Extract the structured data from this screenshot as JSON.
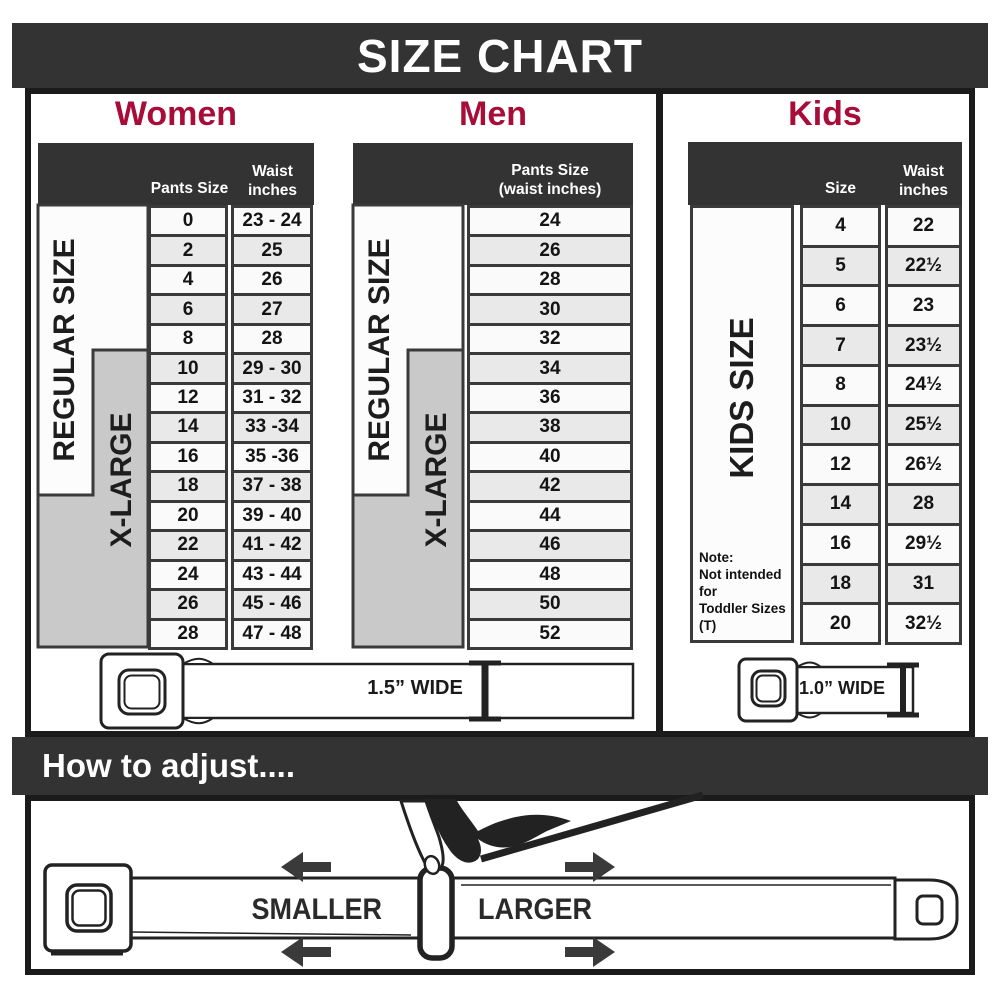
{
  "title": "SIZE CHART",
  "sections": {
    "women": {
      "heading": "Women",
      "header": {
        "pants": "Pants Size",
        "waist_line1": "Waist",
        "waist_line2": "inches"
      },
      "regular_label": "REGULAR SIZE",
      "xlarge_label": "X-LARGE",
      "rows": [
        {
          "pants_size": "0",
          "waist_inches": "23 - 24"
        },
        {
          "pants_size": "2",
          "waist_inches": "25"
        },
        {
          "pants_size": "4",
          "waist_inches": "26"
        },
        {
          "pants_size": "6",
          "waist_inches": "27"
        },
        {
          "pants_size": "8",
          "waist_inches": "28"
        },
        {
          "pants_size": "10",
          "waist_inches": "29 - 30"
        },
        {
          "pants_size": "12",
          "waist_inches": "31 - 32"
        },
        {
          "pants_size": "14",
          "waist_inches": "33 -34"
        },
        {
          "pants_size": "16",
          "waist_inches": "35 -36"
        },
        {
          "pants_size": "18",
          "waist_inches": "37 - 38"
        },
        {
          "pants_size": "20",
          "waist_inches": "39 - 40"
        },
        {
          "pants_size": "22",
          "waist_inches": "41 - 42"
        },
        {
          "pants_size": "24",
          "waist_inches": "43 - 44"
        },
        {
          "pants_size": "26",
          "waist_inches": "45 - 46"
        },
        {
          "pants_size": "28",
          "waist_inches": "47 - 48"
        }
      ]
    },
    "men": {
      "heading": "Men",
      "header": {
        "line1": "Pants Size",
        "line2": "(waist inches)"
      },
      "regular_label": "REGULAR SIZE",
      "xlarge_label": "X-LARGE",
      "rows": [
        "24",
        "26",
        "28",
        "30",
        "32",
        "34",
        "36",
        "38",
        "40",
        "42",
        "44",
        "46",
        "48",
        "50",
        "52"
      ]
    },
    "kids": {
      "heading": "Kids",
      "header": {
        "size": "Size",
        "waist_line1": "Waist",
        "waist_line2": "inches"
      },
      "side_label": "KIDS SIZE",
      "note_lines": [
        "Note:",
        "Not intended for",
        "Toddler Sizes (T)"
      ],
      "rows": [
        {
          "size": "4",
          "waist_inches": "22"
        },
        {
          "size": "5",
          "waist_inches": "22½"
        },
        {
          "size": "6",
          "waist_inches": "23"
        },
        {
          "size": "7",
          "waist_inches": "23½"
        },
        {
          "size": "8",
          "waist_inches": "24½"
        },
        {
          "size": "10",
          "waist_inches": "25½"
        },
        {
          "size": "12",
          "waist_inches": "26½"
        },
        {
          "size": "14",
          "waist_inches": "28"
        },
        {
          "size": "16",
          "waist_inches": "29½"
        },
        {
          "size": "18",
          "waist_inches": "31"
        },
        {
          "size": "20",
          "waist_inches": "32½"
        }
      ]
    }
  },
  "belts": {
    "adult_width_label": "1.5” WIDE",
    "kids_width_label": "1.0” WIDE"
  },
  "how_to_adjust": {
    "heading": "How to adjust....",
    "smaller_label": "SMALLER",
    "larger_label": "LARGER"
  },
  "colors": {
    "heading_red": "#A80D3A",
    "bar_dark": "#333333",
    "border_dark": "#1B1B1B",
    "grid_line": "#3A3A3A",
    "xlarge_gray": "#C9C9C9",
    "row_light": "#FAFAFA",
    "row_shaded": "#E9E9E9"
  }
}
